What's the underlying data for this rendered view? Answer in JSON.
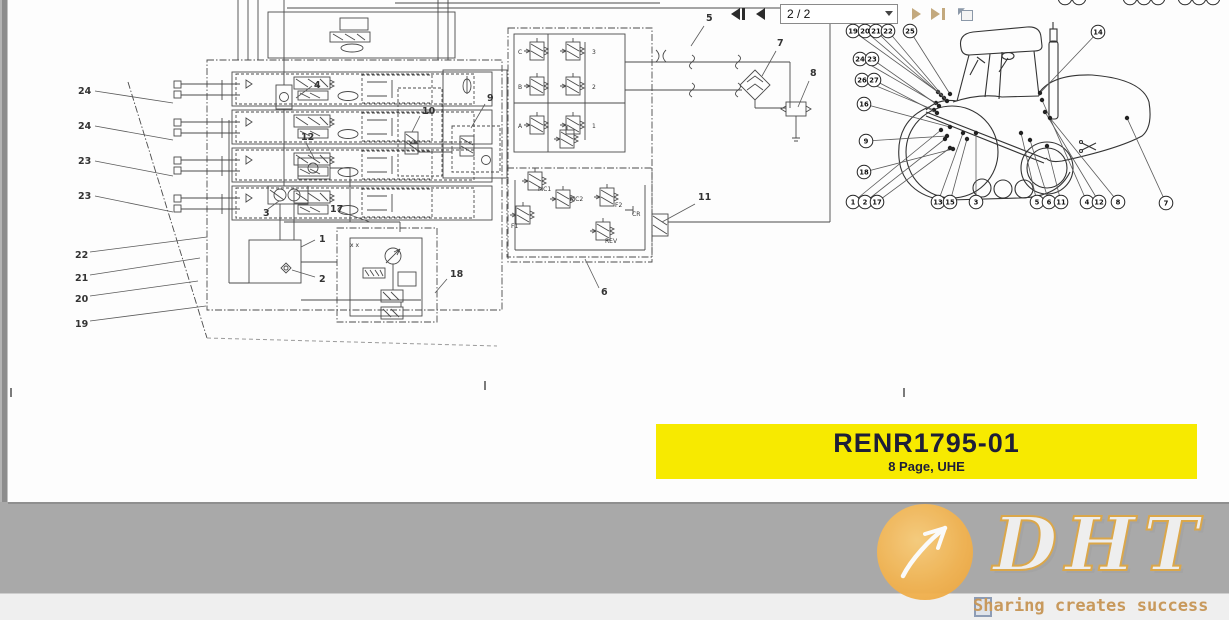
{
  "banner": {
    "title": "RENR1795-01",
    "subtitle": "8 Page, UHE",
    "bg_color": "#f7ea00",
    "text_color": "#1e1e38"
  },
  "toolbar": {
    "page_value": "2 / 2"
  },
  "watermark": {
    "logo": "DHT",
    "slogan": "Sharing creates success",
    "circle_color": "#f2b452",
    "slogan_color": "#c8995c"
  },
  "schematic": {
    "labels": [
      {
        "t": "24",
        "x": 78,
        "y": 94
      },
      {
        "t": "24",
        "x": 78,
        "y": 129
      },
      {
        "t": "23",
        "x": 78,
        "y": 164
      },
      {
        "t": "23",
        "x": 78,
        "y": 199
      },
      {
        "t": "22",
        "x": 75,
        "y": 258
      },
      {
        "t": "21",
        "x": 75,
        "y": 281
      },
      {
        "t": "20",
        "x": 75,
        "y": 302
      },
      {
        "t": "19",
        "x": 75,
        "y": 327
      },
      {
        "t": "4",
        "x": 314,
        "y": 88
      },
      {
        "t": "12",
        "x": 301,
        "y": 140
      },
      {
        "t": "3",
        "x": 263,
        "y": 216
      },
      {
        "t": "17",
        "x": 330,
        "y": 212
      },
      {
        "t": "1",
        "x": 319,
        "y": 242
      },
      {
        "t": "2",
        "x": 319,
        "y": 282
      },
      {
        "t": "18",
        "x": 450,
        "y": 277
      },
      {
        "t": "10",
        "x": 422,
        "y": 114
      },
      {
        "t": "9",
        "x": 487,
        "y": 101
      },
      {
        "t": "5",
        "x": 706,
        "y": 21
      },
      {
        "t": "6",
        "x": 601,
        "y": 295
      },
      {
        "t": "11",
        "x": 698,
        "y": 200
      },
      {
        "t": "7",
        "x": 777,
        "y": 46
      },
      {
        "t": "8",
        "x": 810,
        "y": 76
      }
    ],
    "leaders": [
      [
        95,
        91,
        173,
        103
      ],
      [
        95,
        126,
        173,
        140
      ],
      [
        95,
        161,
        173,
        176
      ],
      [
        95,
        196,
        173,
        212
      ],
      [
        90,
        252,
        207,
        237
      ],
      [
        90,
        275,
        200,
        258
      ],
      [
        90,
        296,
        198,
        281
      ],
      [
        90,
        321,
        206,
        306
      ],
      [
        312,
        86,
        296,
        98
      ],
      [
        306,
        143,
        314,
        158
      ],
      [
        268,
        209,
        279,
        201
      ],
      [
        339,
        211,
        370,
        222
      ],
      [
        315,
        240,
        301,
        247
      ],
      [
        315,
        277,
        292,
        270
      ],
      [
        447,
        279,
        435,
        293
      ],
      [
        420,
        116,
        412,
        132
      ],
      [
        485,
        104,
        471,
        128
      ],
      [
        704,
        26,
        691,
        46
      ],
      [
        599,
        288,
        585,
        259
      ],
      [
        695,
        204,
        662,
        222
      ],
      [
        776,
        51,
        762,
        76
      ],
      [
        809,
        81,
        798,
        107
      ]
    ],
    "valve_labels": [
      {
        "t": "C",
        "x": 518,
        "y": 54
      },
      {
        "t": "B",
        "x": 518,
        "y": 89
      },
      {
        "t": "A",
        "x": 518,
        "y": 128
      },
      {
        "t": "3",
        "x": 592,
        "y": 54
      },
      {
        "t": "2",
        "x": 592,
        "y": 89
      },
      {
        "t": "1",
        "x": 592,
        "y": 128
      },
      {
        "t": "MC1",
        "x": 538,
        "y": 191
      },
      {
        "t": "MC2",
        "x": 570,
        "y": 201
      },
      {
        "t": "F1",
        "x": 511,
        "y": 228
      },
      {
        "t": "F2",
        "x": 615,
        "y": 207
      },
      {
        "t": "CR",
        "x": 632,
        "y": 216
      },
      {
        "t": "REV",
        "x": 605,
        "y": 243
      },
      {
        "t": "x x",
        "x": 350,
        "y": 247
      }
    ]
  },
  "tractor": {
    "callouts": [
      {
        "n": "19",
        "x": 853,
        "y": 31,
        "tx": 938,
        "ty": 92
      },
      {
        "n": "20",
        "x": 865,
        "y": 31,
        "tx": 941,
        "ty": 95
      },
      {
        "n": "21",
        "x": 876,
        "y": 31,
        "tx": 944,
        "ty": 98
      },
      {
        "n": "22",
        "x": 888,
        "y": 31,
        "tx": 947,
        "ty": 101
      },
      {
        "n": "25",
        "x": 910,
        "y": 31,
        "tx": 950,
        "ty": 94
      },
      {
        "n": "24",
        "x": 860,
        "y": 59,
        "tx": 936,
        "ty": 103
      },
      {
        "n": "23",
        "x": 872,
        "y": 59,
        "tx": 939,
        "ty": 106
      },
      {
        "n": "26",
        "x": 862,
        "y": 80,
        "tx": 934,
        "ty": 110
      },
      {
        "n": "27",
        "x": 874,
        "y": 80,
        "tx": 937,
        "ty": 113
      },
      {
        "n": "16",
        "x": 864,
        "y": 104,
        "tx": 950,
        "ty": 127
      },
      {
        "n": "9",
        "x": 866,
        "y": 141,
        "tx": 947,
        "ty": 136
      },
      {
        "n": "18",
        "x": 864,
        "y": 172,
        "tx": 953,
        "ty": 149
      },
      {
        "n": "1",
        "x": 853,
        "y": 202,
        "tx": 941,
        "ty": 130
      },
      {
        "n": "2",
        "x": 865,
        "y": 202,
        "tx": 945,
        "ty": 139
      },
      {
        "n": "17",
        "x": 877,
        "y": 202,
        "tx": 950,
        "ty": 148
      },
      {
        "n": "13",
        "x": 938,
        "y": 202,
        "tx": 963,
        "ty": 133
      },
      {
        "n": "15",
        "x": 950,
        "y": 202,
        "tx": 967,
        "ty": 139
      },
      {
        "n": "3",
        "x": 976,
        "y": 202,
        "tx": 976,
        "ty": 133
      },
      {
        "n": "5",
        "x": 1037,
        "y": 202,
        "tx": 1021,
        "ty": 133
      },
      {
        "n": "6",
        "x": 1049,
        "y": 202,
        "tx": 1030,
        "ty": 140
      },
      {
        "n": "11",
        "x": 1061,
        "y": 202,
        "tx": 1047,
        "ty": 146
      },
      {
        "n": "4",
        "x": 1087,
        "y": 202,
        "tx": 1042,
        "ty": 100
      },
      {
        "n": "12",
        "x": 1099,
        "y": 202,
        "tx": 1045,
        "ty": 112
      },
      {
        "n": "8",
        "x": 1118,
        "y": 202,
        "tx": 1050,
        "ty": 118
      },
      {
        "n": "7",
        "x": 1166,
        "y": 203,
        "tx": 1127,
        "ty": 118
      },
      {
        "n": "14",
        "x": 1098,
        "y": 32,
        "tx": 1040,
        "ty": 93
      }
    ],
    "top_partial_xs": [
      1065,
      1079,
      1130,
      1144,
      1158,
      1185,
      1199,
      1213
    ]
  }
}
